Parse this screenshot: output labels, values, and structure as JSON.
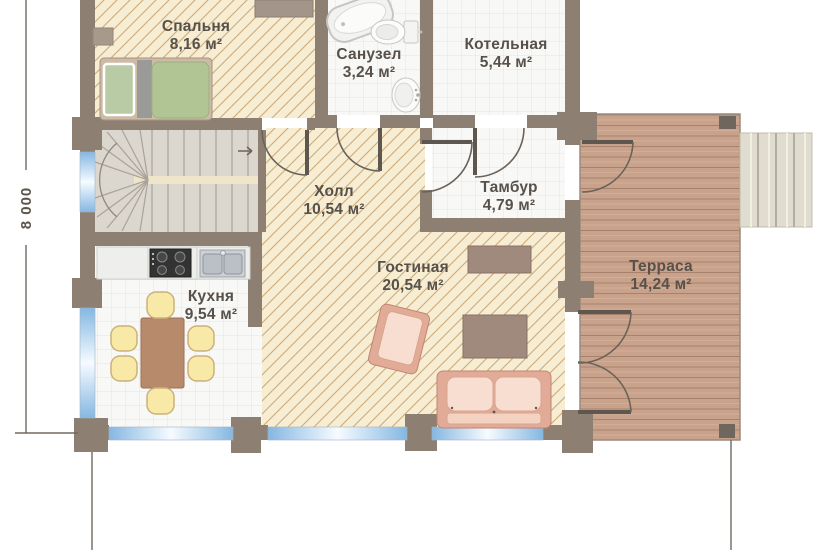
{
  "plan": {
    "type": "floor-plan",
    "dimension_label": "8 000",
    "rooms": [
      {
        "key": "bedroom",
        "name": "Спальня",
        "area": "8,16 м²"
      },
      {
        "key": "bathroom",
        "name": "Санузел",
        "area": "3,24 м²"
      },
      {
        "key": "boiler_room",
        "name": "Котельная",
        "area": "5,44 м²"
      },
      {
        "key": "hall",
        "name": "Холл",
        "area": "10,54 м²"
      },
      {
        "key": "vestibule",
        "name": "Тамбур",
        "area": "4,79 м²"
      },
      {
        "key": "kitchen",
        "name": "Кухня",
        "area": "9,54 м²"
      },
      {
        "key": "living_room",
        "name": "Гостиная",
        "area": "20,54 м²"
      },
      {
        "key": "terrace",
        "name": "Терраса",
        "area": "14,24 м²"
      }
    ],
    "colors": {
      "wall": "#8d8073",
      "hatched_floor": "#f6edd3",
      "hatch_line": "#cdab7c",
      "tile_floor": "#f8f8f6",
      "terrace_wood": "#c9a28c",
      "window_glass": "#85b7e2",
      "label_text": "#57514a",
      "furniture_pink": "#e2ab97",
      "furniture_yellow": "#f9e9a6",
      "mattress_green": "#b0c494"
    }
  }
}
